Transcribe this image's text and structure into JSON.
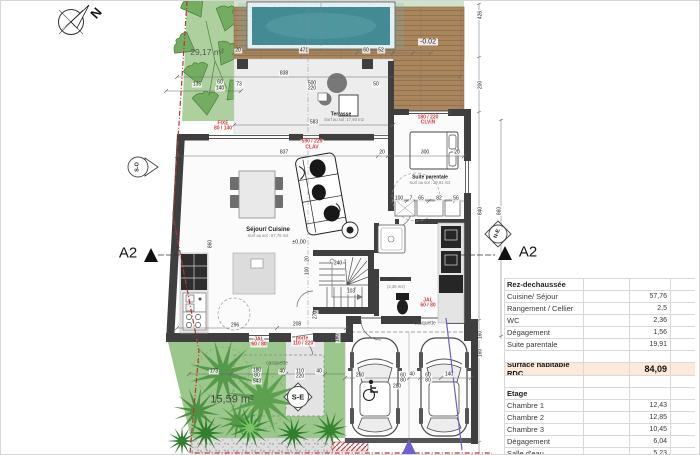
{
  "table": {
    "rows": [
      {
        "type": "header",
        "label": "Rez-dechaussée",
        "value": ""
      },
      {
        "type": "item",
        "label": "Cuisine/ Séjour",
        "value": "57,76"
      },
      {
        "type": "item",
        "label": "Rangement / Cellier",
        "value": "2,5"
      },
      {
        "type": "item",
        "label": "WC",
        "value": "2,36"
      },
      {
        "type": "item",
        "label": "Dégagement",
        "value": "1,56"
      },
      {
        "type": "item",
        "label": "Suite parentale",
        "value": "19,91"
      },
      {
        "type": "blank",
        "label": "",
        "value": ""
      },
      {
        "type": "total",
        "label": "Surface habitable RDC",
        "value": "84,09"
      },
      {
        "type": "blank",
        "label": "",
        "value": ""
      },
      {
        "type": "header",
        "label": "Etage",
        "value": ""
      },
      {
        "type": "item",
        "label": "Chambre 1",
        "value": "12,43"
      },
      {
        "type": "item",
        "label": "Chambre 2",
        "value": "12,85"
      },
      {
        "type": "item",
        "label": "Chambre 3",
        "value": "10,45"
      },
      {
        "type": "item",
        "label": "Dégagement",
        "value": "6,04"
      },
      {
        "type": "item",
        "label": "Salle d'eau",
        "value": "5,23"
      },
      {
        "type": "item",
        "label": "WC",
        "value": "2,41"
      }
    ]
  },
  "plan": {
    "areas": {
      "garden_top": "29,17 m²",
      "garden_bottom": "15,59 m²"
    },
    "rooms": {
      "sejour": {
        "name": "Séjour/ Cuisine",
        "sub": "Surf au sol : 57,76 m2"
      },
      "suite": {
        "name": "Suite parentale",
        "sub": "Surf au sol : 19,91 m2"
      },
      "terrasse": {
        "name": "Terrasse",
        "sub": "Surf au sol :17,93 m2"
      },
      "wc": {
        "name": "WC",
        "sub": "(2,36 m2)"
      }
    },
    "levels": {
      "terrace": "-0.02",
      "ground": "±0,00"
    },
    "casquette": {
      "a": "casquette",
      "b": "casquette"
    },
    "section": {
      "label": "A2"
    },
    "compass": {
      "north": "N",
      "so": "S-O",
      "ne": "N-E",
      "se": "S-E"
    },
    "labels": [
      {
        "t": "20",
        "x": 237,
        "y": 50,
        "c": "d"
      },
      {
        "t": "471",
        "x": 303,
        "y": 50,
        "c": "d"
      },
      {
        "t": "60",
        "x": 365,
        "y": 50,
        "c": "d"
      },
      {
        "t": "52",
        "x": 380,
        "y": 50,
        "c": "d"
      },
      {
        "t": "135",
        "x": 196,
        "y": 84,
        "c": "d"
      },
      {
        "t": "60",
        "x": 219,
        "y": 82,
        "c": "d"
      },
      {
        "t": "140",
        "x": 219,
        "y": 88,
        "c": "d"
      },
      {
        "t": "73",
        "x": 238,
        "y": 84,
        "c": "d"
      },
      {
        "t": "838",
        "x": 283,
        "y": 73,
        "c": "d"
      },
      {
        "t": "500",
        "x": 311,
        "y": 83,
        "c": "d"
      },
      {
        "t": "220",
        "x": 311,
        "y": 88,
        "c": "d"
      },
      {
        "t": "50",
        "x": 375,
        "y": 84,
        "c": "d"
      },
      {
        "t": "583",
        "x": 313,
        "y": 122,
        "c": "d"
      },
      {
        "t": "837",
        "x": 283,
        "y": 152,
        "c": "d"
      },
      {
        "t": "20",
        "x": 381,
        "y": 152,
        "c": "d"
      },
      {
        "t": "300",
        "x": 424,
        "y": 152,
        "c": "d"
      },
      {
        "t": "20",
        "x": 456,
        "y": 152,
        "c": "d"
      },
      {
        "t": "860",
        "x": 210,
        "y": 243,
        "c": "dr"
      },
      {
        "t": "426",
        "x": 480,
        "y": 14,
        "c": "dr"
      },
      {
        "t": "200",
        "x": 480,
        "y": 84,
        "c": "dr"
      },
      {
        "t": "840",
        "x": 480,
        "y": 210,
        "c": "dr"
      },
      {
        "t": "860",
        "x": 499,
        "y": 210,
        "c": "dr"
      },
      {
        "t": "160",
        "x": 480,
        "y": 334,
        "c": "dr"
      },
      {
        "t": "160",
        "x": 480,
        "y": 352,
        "c": "dr"
      },
      {
        "t": "160",
        "x": 337,
        "y": 337,
        "c": "dr"
      },
      {
        "t": "296",
        "x": 234,
        "y": 325,
        "c": "d"
      },
      {
        "t": "208",
        "x": 296,
        "y": 324,
        "c": "d"
      },
      {
        "t": "20",
        "x": 307,
        "y": 258,
        "c": "dr"
      },
      {
        "t": "100",
        "x": 307,
        "y": 270,
        "c": "dr"
      },
      {
        "t": "270",
        "x": 315,
        "y": 314,
        "c": "dr"
      },
      {
        "t": "100",
        "x": 398,
        "y": 198,
        "c": "d"
      },
      {
        "t": "7",
        "x": 410,
        "y": 198,
        "c": "d"
      },
      {
        "t": "65",
        "x": 420,
        "y": 198,
        "c": "d"
      },
      {
        "t": "82",
        "x": 438,
        "y": 198,
        "c": "d"
      },
      {
        "t": "56",
        "x": 455,
        "y": 198,
        "c": "d"
      },
      {
        "t": "173",
        "x": 213,
        "y": 371,
        "c": "d"
      },
      {
        "t": "180",
        "x": 256,
        "y": 370,
        "c": "d"
      },
      {
        "t": "80",
        "x": 256,
        "y": 375,
        "c": "d"
      },
      {
        "t": "543",
        "x": 256,
        "y": 381,
        "c": "d"
      },
      {
        "t": "40",
        "x": 281,
        "y": 371,
        "c": "d"
      },
      {
        "t": "110",
        "x": 299,
        "y": 371,
        "c": "d"
      },
      {
        "t": "220",
        "x": 299,
        "y": 376,
        "c": "d"
      },
      {
        "t": "40",
        "x": 318,
        "y": 371,
        "c": "d"
      },
      {
        "t": "260",
        "x": 359,
        "y": 375,
        "c": "d"
      },
      {
        "t": "60",
        "x": 402,
        "y": 375,
        "c": "d"
      },
      {
        "t": "80",
        "x": 402,
        "y": 380,
        "c": "d"
      },
      {
        "t": "40",
        "x": 411,
        "y": 374,
        "c": "d"
      },
      {
        "t": "60",
        "x": 427,
        "y": 375,
        "c": "d"
      },
      {
        "t": "80",
        "x": 427,
        "y": 380,
        "c": "d"
      },
      {
        "t": "140",
        "x": 448,
        "y": 374,
        "c": "d"
      },
      {
        "t": "280",
        "x": 396,
        "y": 386,
        "c": "d"
      },
      {
        "t": "240",
        "x": 337,
        "y": 263,
        "c": "d"
      },
      {
        "t": "103",
        "x": 350,
        "y": 291,
        "c": "d"
      },
      {
        "t": "FIXE",
        "x": 222,
        "y": 123,
        "c": "red"
      },
      {
        "t": "80 / 140",
        "x": 222,
        "y": 128,
        "c": "red"
      },
      {
        "t": "590 / 225",
        "x": 311,
        "y": 141,
        "c": "red"
      },
      {
        "t": "CLAV",
        "x": 311,
        "y": 147,
        "c": "red"
      },
      {
        "t": "180 / 220",
        "x": 427,
        "y": 117,
        "c": "red"
      },
      {
        "t": "CLViN",
        "x": 427,
        "y": 122,
        "c": "red"
      },
      {
        "t": "JAL",
        "x": 258,
        "y": 339,
        "c": "red"
      },
      {
        "t": "60 / 80",
        "x": 258,
        "y": 344,
        "c": "red"
      },
      {
        "t": "porte",
        "x": 301,
        "y": 338,
        "c": "red"
      },
      {
        "t": "110 / 220",
        "x": 302,
        "y": 343,
        "c": "red"
      },
      {
        "t": "JAL",
        "x": 427,
        "y": 300,
        "c": "red"
      },
      {
        "t": "60 / 80",
        "x": 427,
        "y": 305,
        "c": "red"
      }
    ],
    "colors": {
      "pool_water": "#3a828c",
      "deck_wood": "#aa865f",
      "wall": "#3f3f3f",
      "garden_green": "#9cc78c",
      "boundary_red": "#b03a2e",
      "highlight_peach": "#fde9d9",
      "window_spec_red": "#d33c3c",
      "arrow_purple": "#6f5fd0"
    }
  }
}
